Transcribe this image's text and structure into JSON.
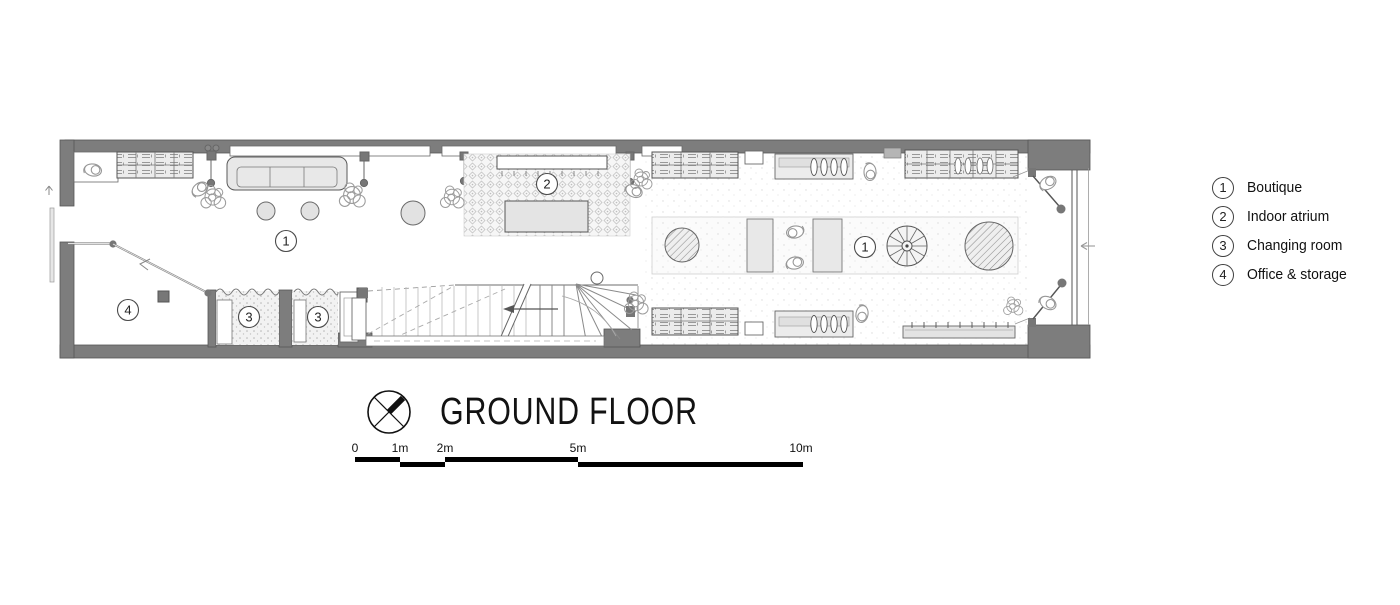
{
  "title": "GROUND FLOOR",
  "legend": [
    {
      "number": "1",
      "label": "Boutique"
    },
    {
      "number": "2",
      "label": "Indoor atrium"
    },
    {
      "number": "3",
      "label": "Changing room"
    },
    {
      "number": "4",
      "label": "Office & storage"
    }
  ],
  "room_labels": [
    {
      "number": "1",
      "room": "boutique-left"
    },
    {
      "number": "2",
      "room": "indoor-atrium"
    },
    {
      "number": "3",
      "room": "changing-room-1"
    },
    {
      "number": "3",
      "room": "changing-room-2"
    },
    {
      "number": "4",
      "room": "office-storage"
    },
    {
      "number": "1",
      "room": "boutique-right"
    }
  ],
  "scale": {
    "ticks": [
      "0",
      "1m",
      "2m",
      "5m",
      "10m"
    ]
  },
  "icons": {
    "north": "north-arrow-icon"
  },
  "colors": {
    "wall": "#7d7d7d",
    "line": "#444444",
    "furniture_fill": "#e8e8e8",
    "hatch": "#8f8f8f",
    "paper": "#ffffff"
  }
}
